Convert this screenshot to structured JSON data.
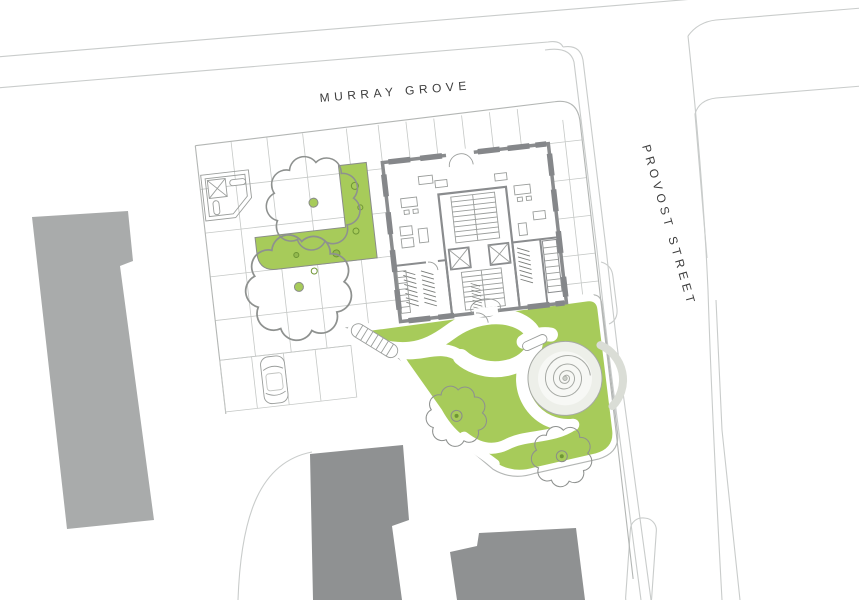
{
  "labels": {
    "murray_grove": "MURRAY GROVE",
    "provost_street": "PROVOST STREET"
  },
  "palette": {
    "background": "#ffffff",
    "green": "#a7cb5a",
    "green_dark": "#6f9635",
    "context_light": "#a9abab",
    "context_dark": "#8f9192",
    "wall": "#8a8c8e",
    "window": "#85878a",
    "street_line": "#c9cccb",
    "grid_line": "#c5c8c6",
    "boundary": "#b3b6b4",
    "detail_line": "#9a9d9b",
    "spiral_line": "#a6a9a4",
    "label_text": "#3d3d3d"
  },
  "symbols": [
    "context-building",
    "paving-grid",
    "lawn",
    "path",
    "tree-canopy",
    "tree-trunk",
    "planter",
    "play-frame",
    "bench",
    "car",
    "parking-bay",
    "ramp-steps",
    "spiral-mound",
    "seat-wall",
    "staircase",
    "elevator",
    "bike-rack",
    "door-swing",
    "window-bar",
    "kerb-line"
  ]
}
